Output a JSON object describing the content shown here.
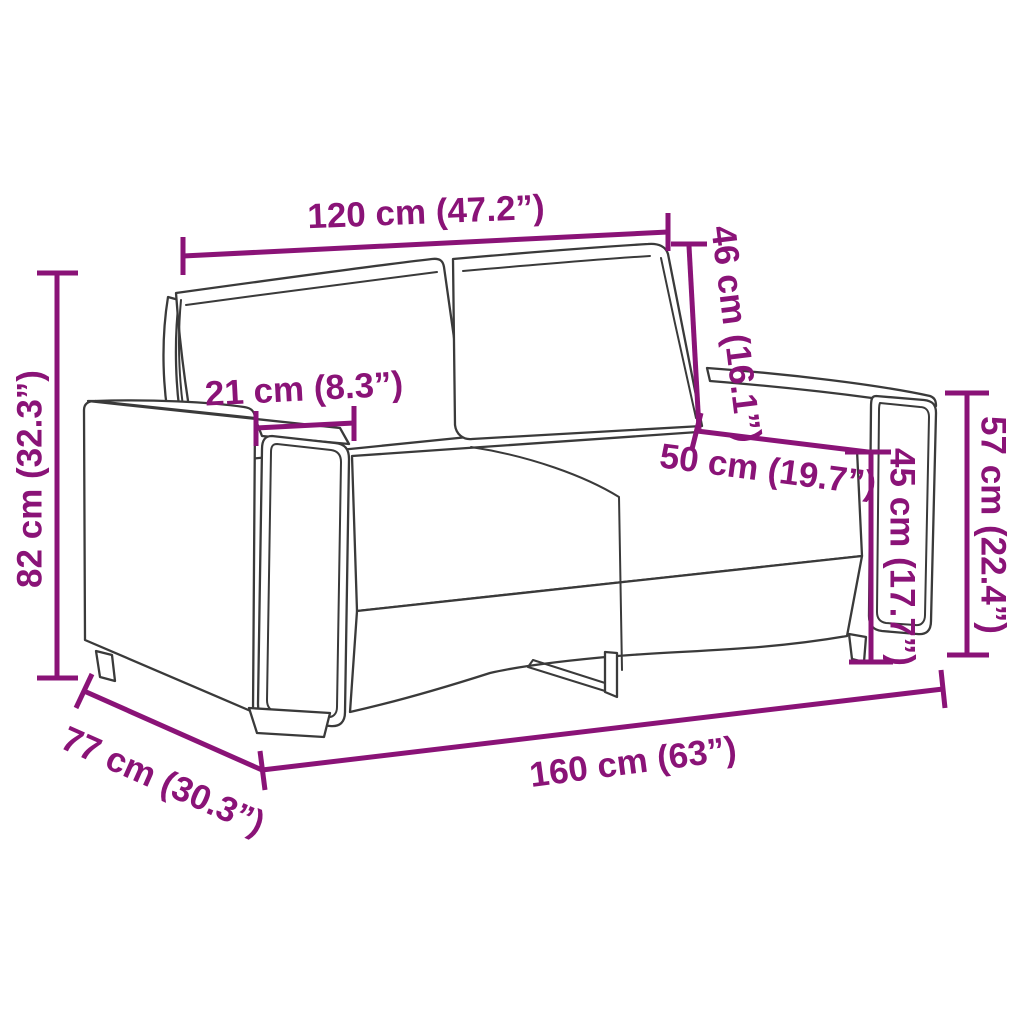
{
  "figure": {
    "kind": "product dimension diagram",
    "subject": "two-seater sofa line drawing"
  },
  "colors": {
    "dimension_accent": "#8A1377",
    "drawing_outline": "#3A3A3A",
    "background": "#FFFFFF"
  },
  "dimensions": {
    "back_width": {
      "label": "120 cm (47.2”)",
      "cm": 120,
      "inches": 47.2
    },
    "back_cushion_height": {
      "label": "46 cm (16.1”)",
      "cm": 46,
      "inches": 16.1
    },
    "armrest_width": {
      "label": "21 cm (8.3”)",
      "cm": 21,
      "inches": 8.3
    },
    "seat_depth": {
      "label": "50 cm (19.7”)",
      "cm": 50,
      "inches": 19.7
    },
    "overall_height": {
      "label": "82 cm (32.3”)",
      "cm": 82,
      "inches": 32.3
    },
    "seat_height": {
      "label": "45 cm (17.7”)",
      "cm": 45,
      "inches": 17.7
    },
    "armrest_height": {
      "label": "57 cm (22.4”)",
      "cm": 57,
      "inches": 22.4
    },
    "overall_depth": {
      "label": "77 cm (30.3”)",
      "cm": 77,
      "inches": 30.3
    },
    "overall_width": {
      "label": "160 cm (63”)",
      "cm": 160,
      "inches": 63
    }
  }
}
